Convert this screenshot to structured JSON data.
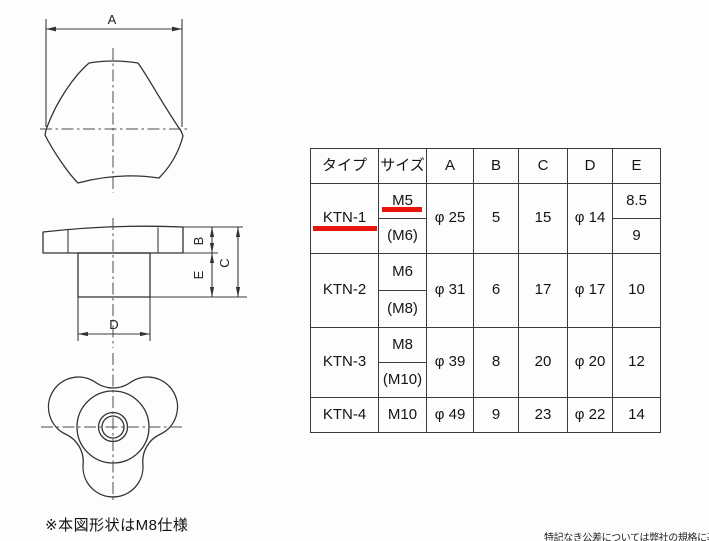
{
  "drawings": {
    "front_view": {
      "dim_label": "A"
    },
    "side_view": {
      "dim_b": "B",
      "dim_c": "C",
      "dim_d": "D",
      "dim_e": "E"
    },
    "note": "※本図形状はM8仕様"
  },
  "table": {
    "headers": [
      "タイプ",
      "サイズ",
      "A",
      "B",
      "C",
      "D",
      "E"
    ],
    "rows": [
      {
        "type": "KTN-1",
        "size_primary": "M5",
        "size_alt": "(M6)",
        "a": "φ 25",
        "b": "5",
        "c": "15",
        "d": "φ 14",
        "e_primary": "8.5",
        "e_alt": "9",
        "highlighted": true
      },
      {
        "type": "KTN-2",
        "size_primary": "M6",
        "size_alt": "(M8)",
        "a": "φ 31",
        "b": "6",
        "c": "17",
        "d": "φ 17",
        "e": "10"
      },
      {
        "type": "KTN-3",
        "size_primary": "M8",
        "size_alt": "(M10)",
        "a": "φ 39",
        "b": "8",
        "c": "20",
        "d": "φ 20",
        "e": "12"
      },
      {
        "type": "KTN-4",
        "size_primary": "M10",
        "a": "φ 49",
        "b": "9",
        "c": "23",
        "d": "φ 22",
        "e": "14"
      }
    ]
  },
  "footer_note": "特記なき公差については弊社の規格に基",
  "colors": {
    "highlight_red": "#e8150d",
    "line": "#3a3a3a",
    "background": "#fdfdfd"
  }
}
